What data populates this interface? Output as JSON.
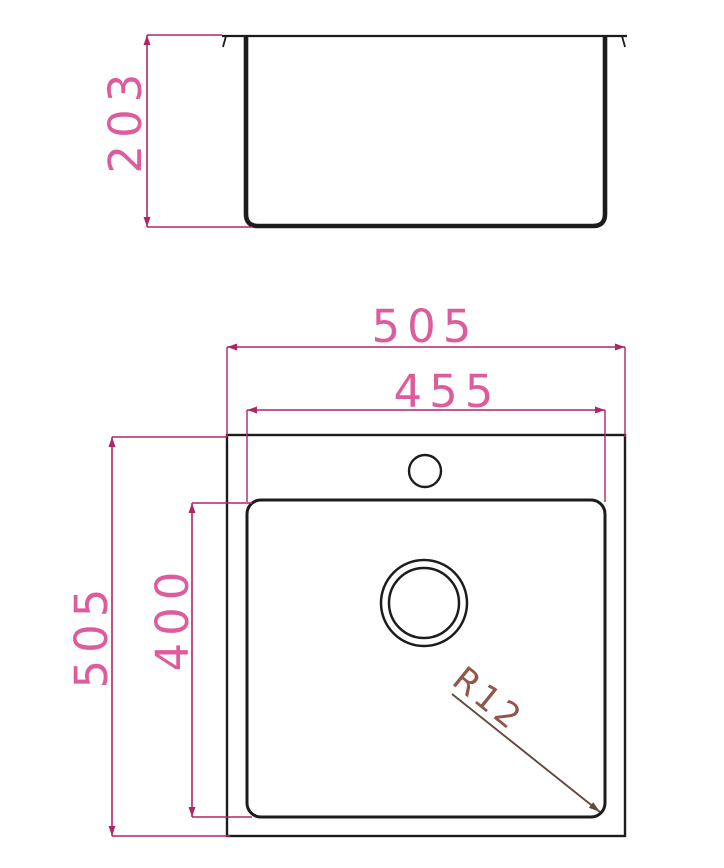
{
  "drawing": {
    "description": "sink technical drawing",
    "side_view": {
      "depth_dimension": "203"
    },
    "plan_view": {
      "outer_width_dimension": "505",
      "bowl_width_dimension": "455",
      "outer_depth_dimension": "505",
      "bowl_depth_dimension": "400",
      "corner_radius_annotation": "R12"
    },
    "colors": {
      "outline": "#1c1c1c",
      "dimension_line": "#b02568",
      "dimension_text": "#dd5c9d",
      "radius_line": "#63493f",
      "radius_text": "#91584a"
    }
  }
}
